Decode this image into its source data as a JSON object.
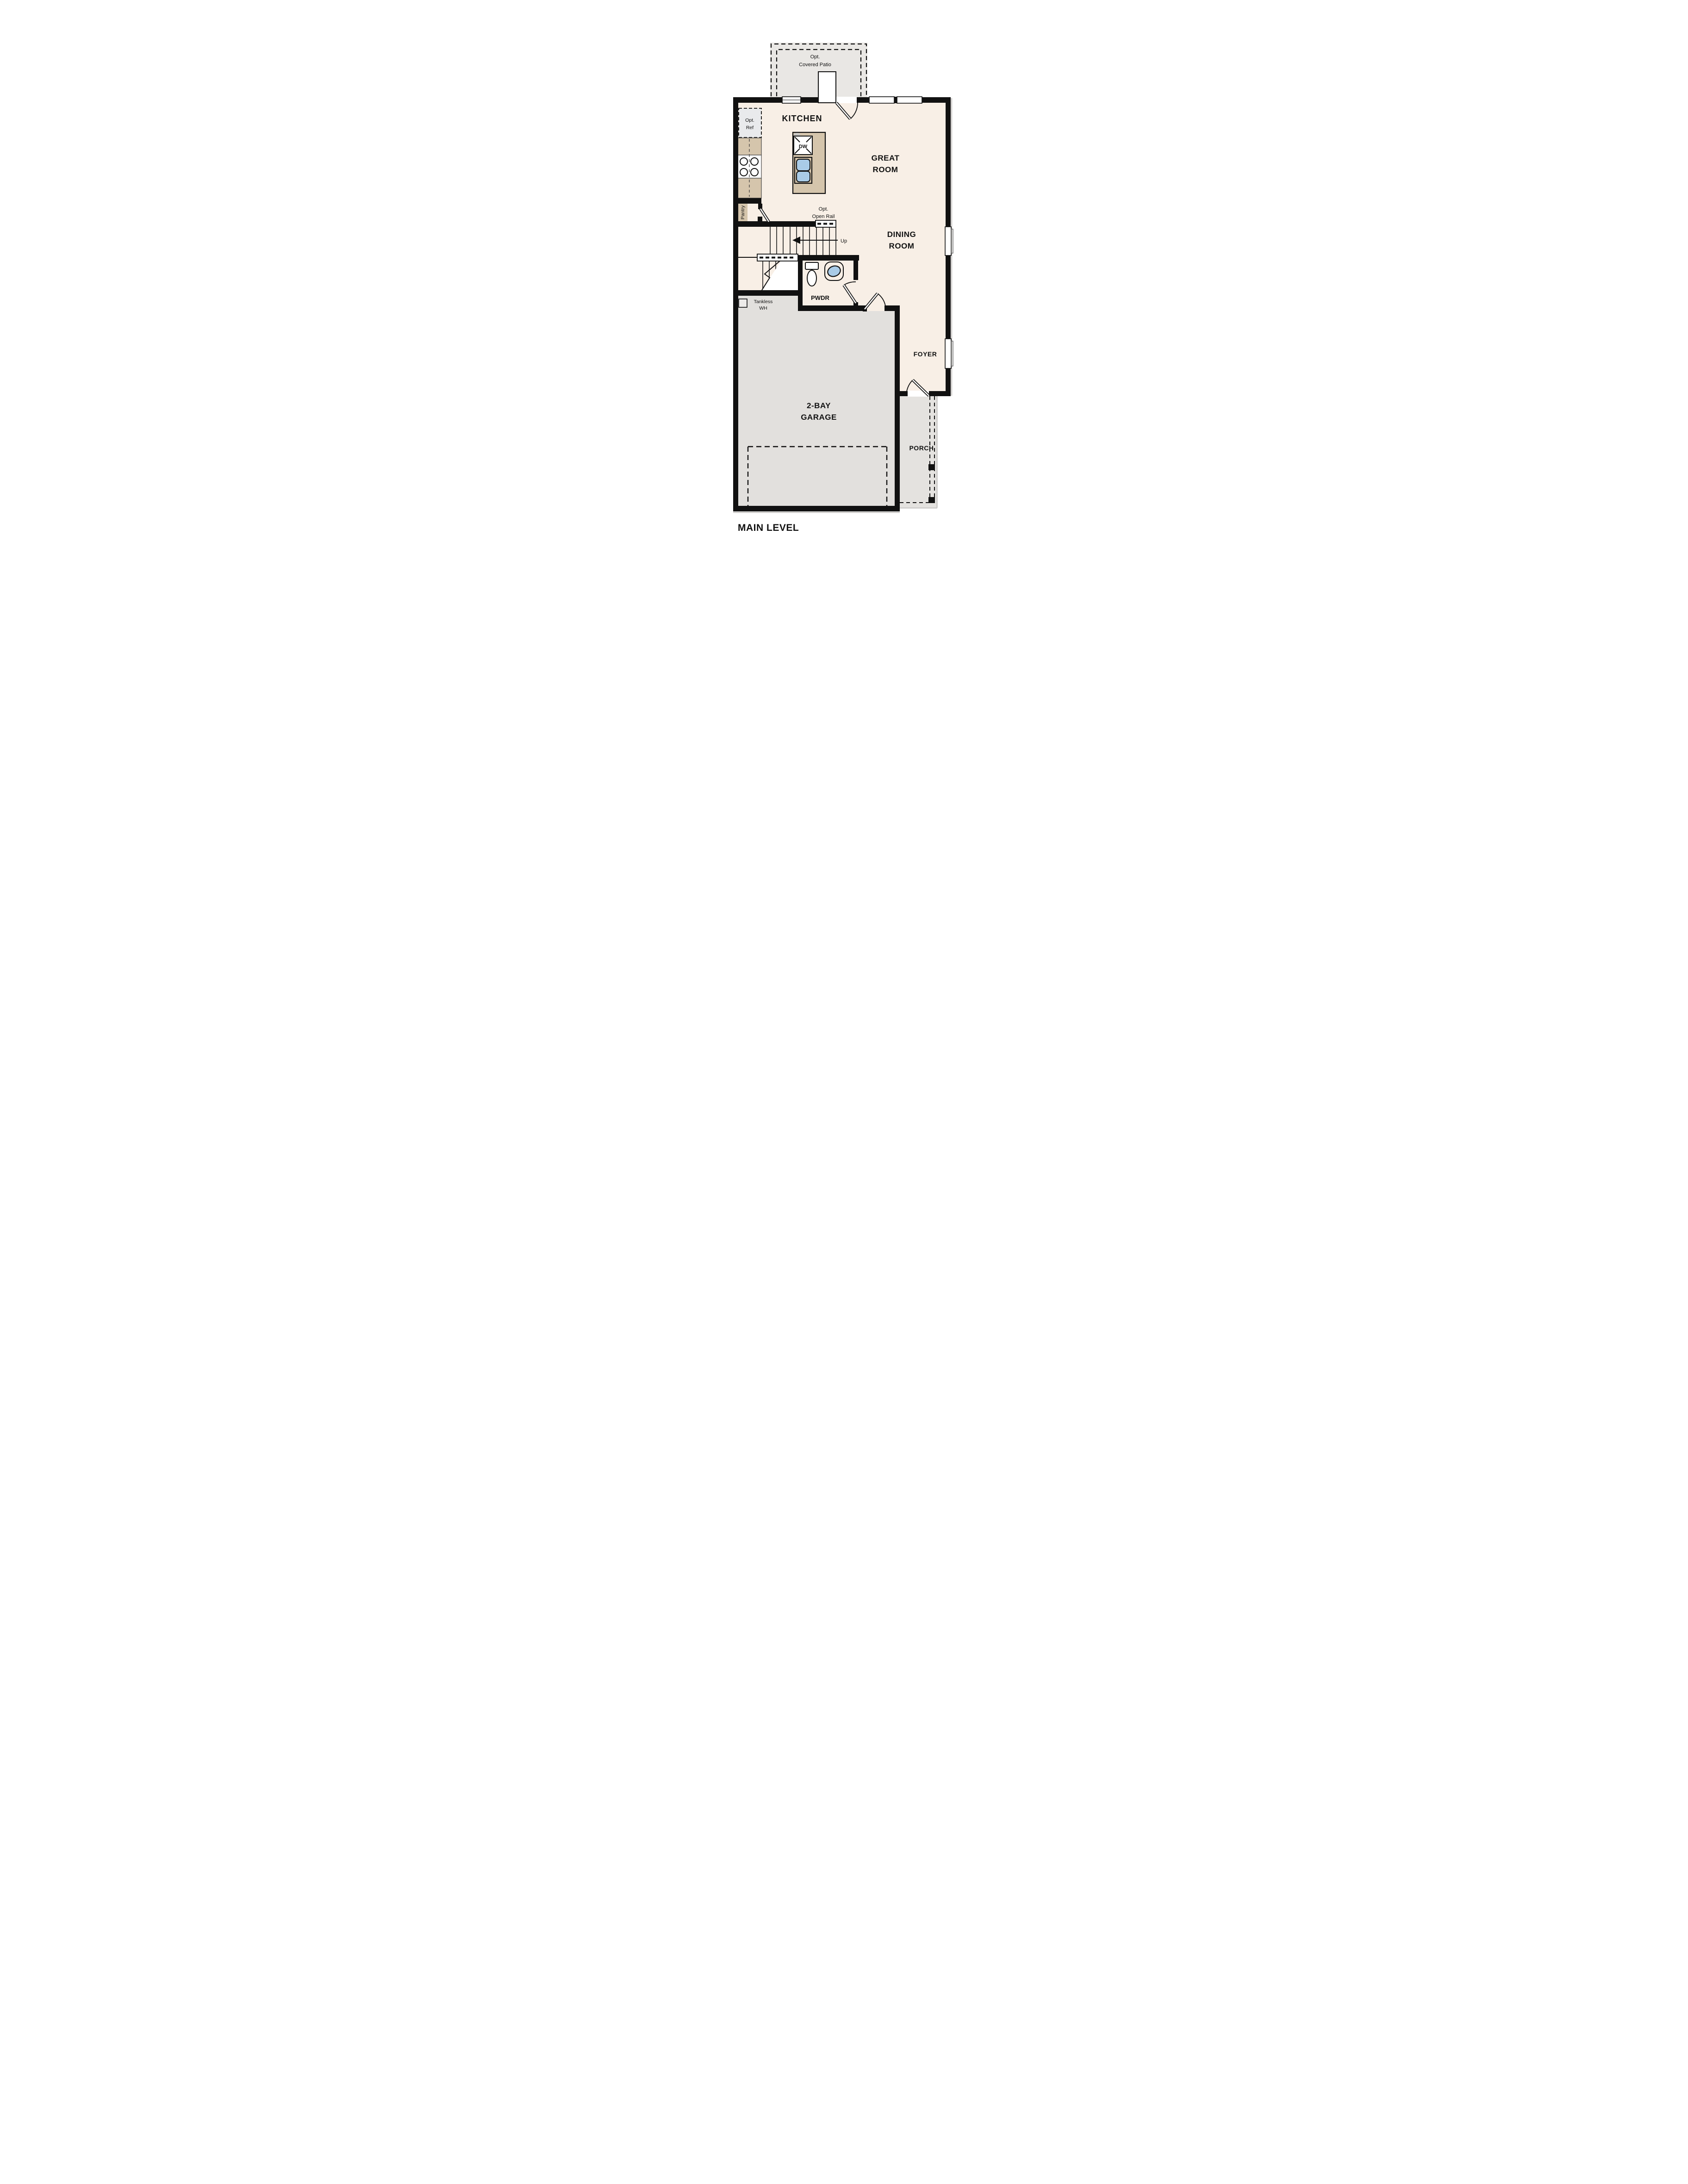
{
  "plan": {
    "patio": {
      "line1": "Opt.",
      "line2": "Covered Patio"
    },
    "kitchen": {
      "label": "KITCHEN",
      "pantry": "Pantry",
      "dw": "DW",
      "opt_ref": {
        "line1": "Opt.",
        "line2": "Ref"
      }
    },
    "great_room": {
      "line1": "GREAT",
      "line2": "ROOM"
    },
    "dining_room": {
      "line1": "DINING",
      "line2": "ROOM"
    },
    "stairs": {
      "up": "Up",
      "rail": {
        "line1": "Opt.",
        "line2": "Open Rail"
      }
    },
    "pwdr": {
      "label": "PWDR"
    },
    "water_heater": {
      "line1": "Tankless",
      "line2": "WH"
    },
    "foyer": {
      "label": "FOYER"
    },
    "garage": {
      "line1": "2-BAY",
      "line2": "GARAGE"
    },
    "porch": {
      "label": "PORCH"
    },
    "footer": {
      "title": "MAIN LEVEL"
    }
  },
  "colors": {
    "floor": "#f8efe6",
    "patio": "#e9e7e4",
    "garage": "#e2e0dd",
    "porch": "#e4e2df",
    "counter": "#d5c5ac",
    "wall": "#111111",
    "sink_blue": "#a9cbe7",
    "ref_fill": "#e9eaec"
  }
}
